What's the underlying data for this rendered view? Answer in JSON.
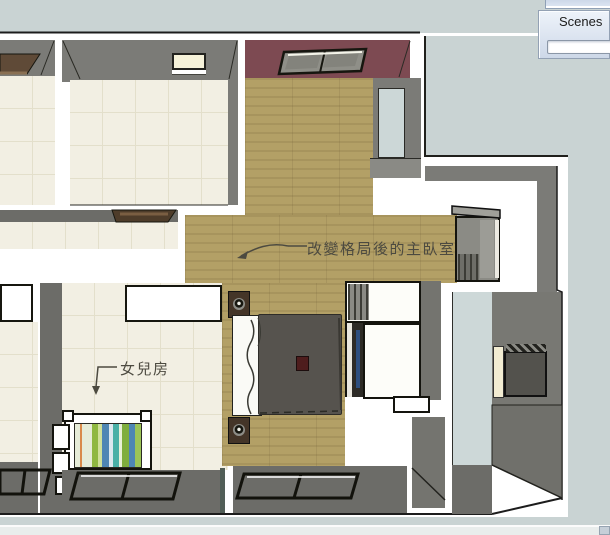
{
  "window": {
    "background": "#c9d3d3",
    "statusbar_color": "#e9edec"
  },
  "scenes_panel": {
    "title": "Scenes"
  },
  "viewport": {
    "annotations": {
      "master": {
        "text": "改變格局後的主臥室"
      },
      "daughter": {
        "text": "女兒房"
      }
    },
    "palette": {
      "wall_grey": "#7b7b77",
      "wall_dark": "#6c6c68",
      "floor_cream": "#f2efe3",
      "floor_wood": "#b3a066",
      "wall_maroon": "#7d4a52",
      "window_glass": "#ccd7d7",
      "bath_floor": "#cdd8d8",
      "duvet_grey": "#56534e",
      "bed_white": "#fafaf6",
      "accent_red": "#4e1d1d",
      "annotation_text": "#4c4a40"
    }
  }
}
